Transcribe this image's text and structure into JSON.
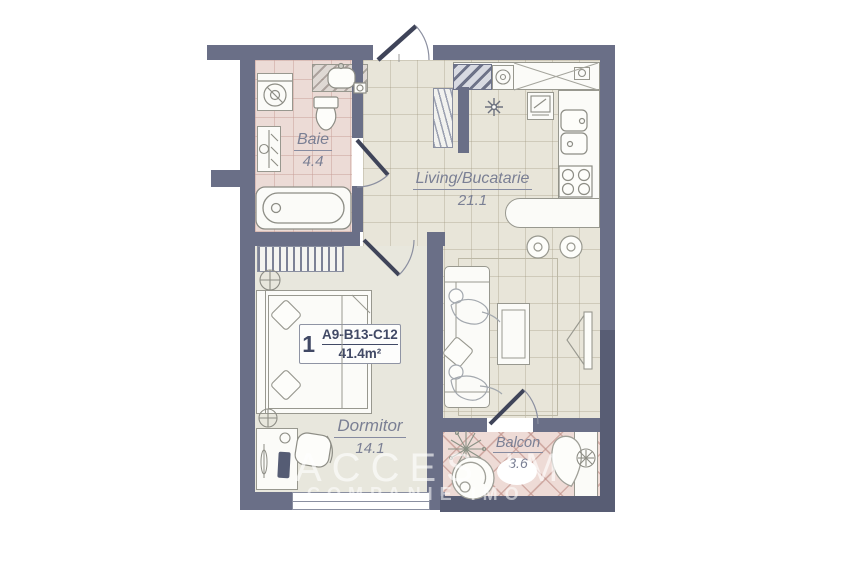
{
  "rooms": {
    "baie": {
      "name": "Baie",
      "area": "4.4"
    },
    "living": {
      "name": "Living/Bucatarie",
      "area": "21.1"
    },
    "dormitor": {
      "name": "Dormitor",
      "area": "14.1"
    },
    "balcon": {
      "name": "Balcon",
      "area": "3.6"
    }
  },
  "unit": {
    "index": "1",
    "code": "A9-B13-C12",
    "area": "41.4m²"
  },
  "watermark": {
    "line1": "ACCES IM",
    "line2": "COMPANIE IMO"
  },
  "colors": {
    "wall": "#6a6f87",
    "wall_dark": "#585d74",
    "floor_main": "#e8e5d9",
    "floor_bath": "#ecdbd6",
    "floor_balcony": "#eedbd6",
    "floor_bedroom": "#e8e7dd",
    "label_text": "#7a7f94",
    "unit_text": "#414965"
  }
}
